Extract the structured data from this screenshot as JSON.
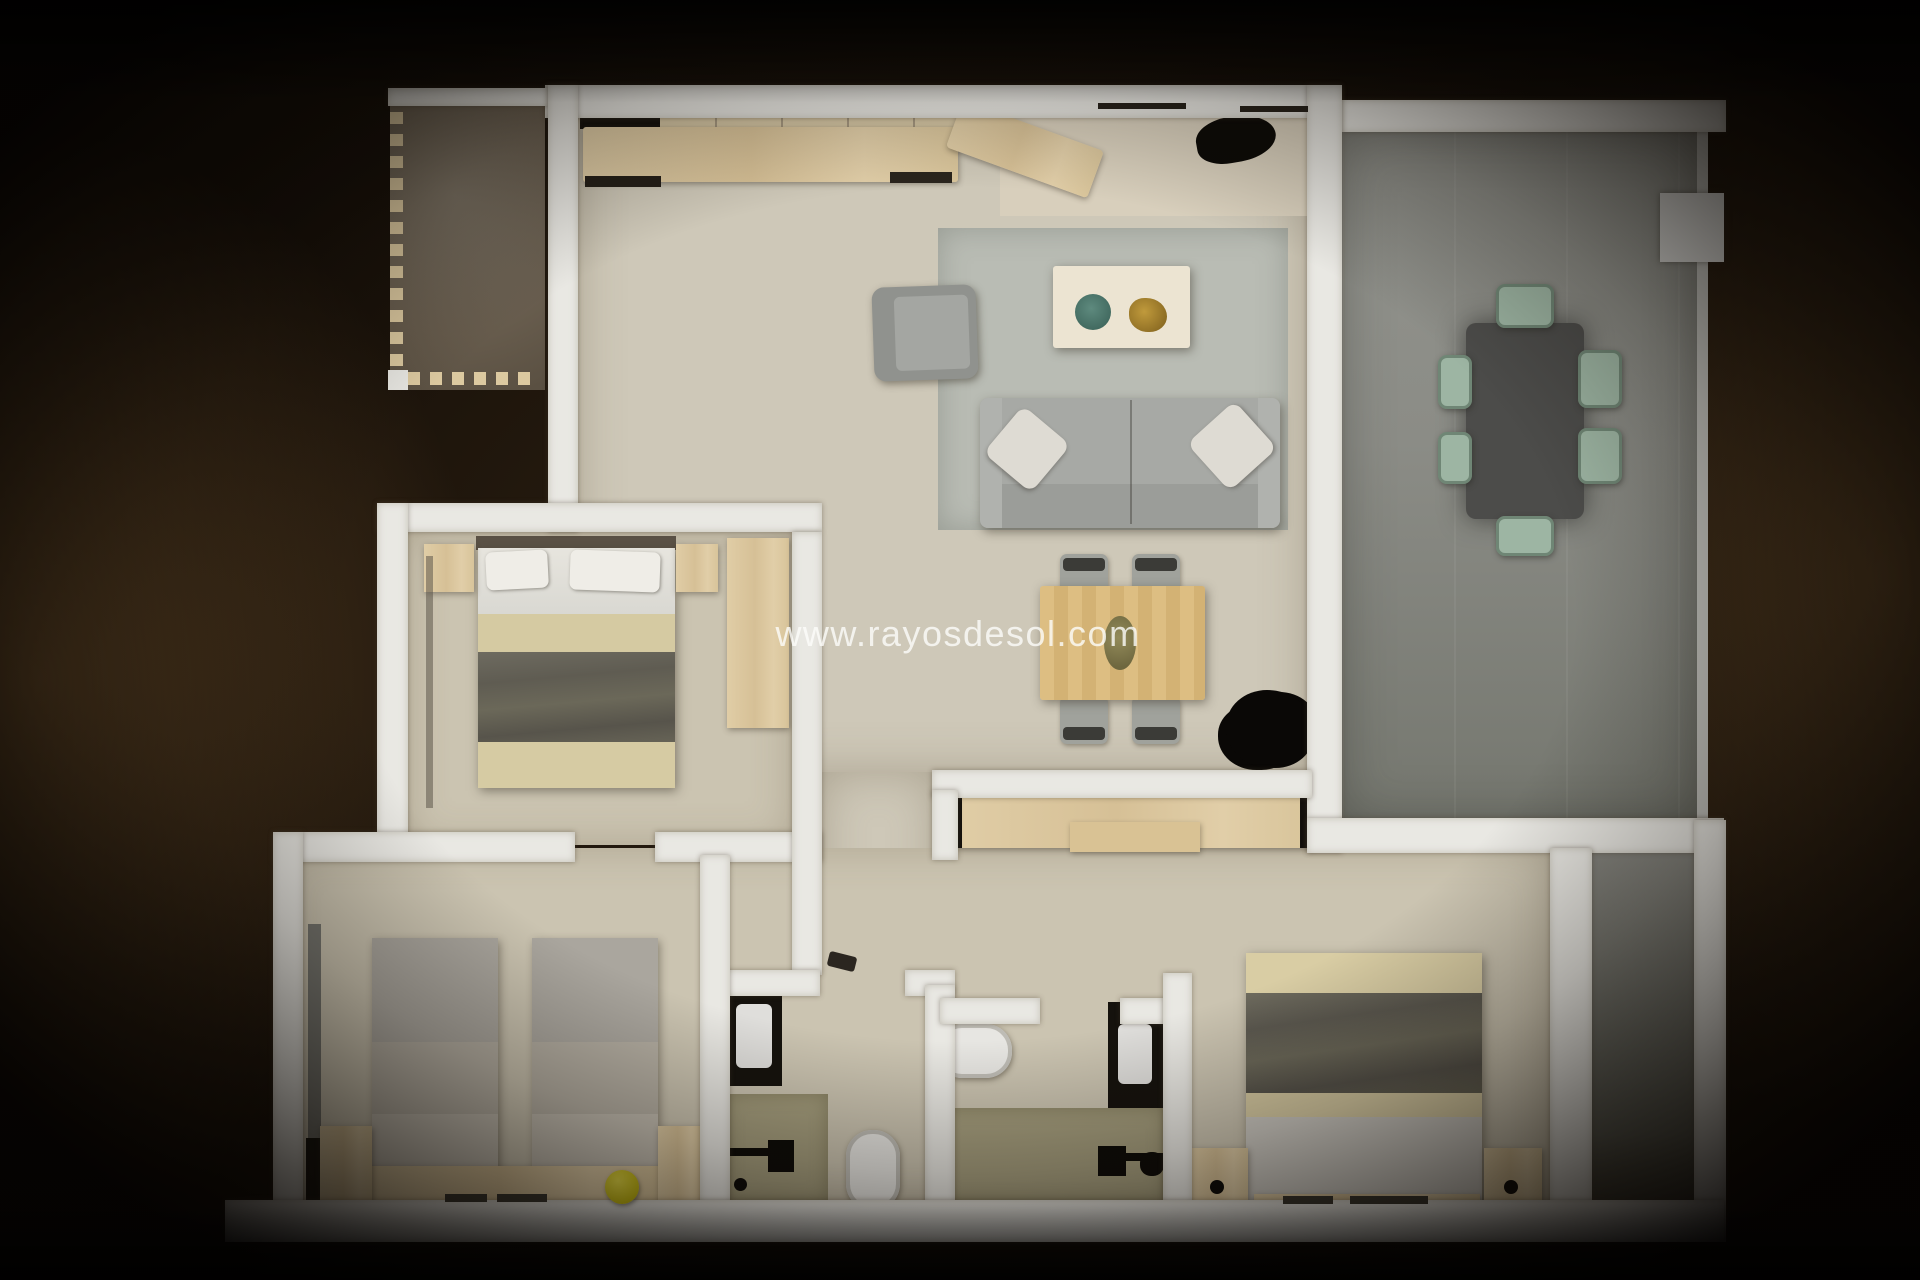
{
  "watermark": {
    "text": "www.rayosdesol.com"
  },
  "scene": {
    "type": "3d-rendered-floor-plan-top-view",
    "description": "Top-down 3D render of an apartment floor plan on a dark brown vignetted background"
  },
  "rooms": [
    {
      "name": "kitchen",
      "furniture": [
        "counter-run",
        "upper-cabinets",
        "black-appliance",
        "corner-counter",
        "sink-unit"
      ]
    },
    {
      "name": "living-room",
      "furniture": [
        "area-rug",
        "sofa-with-pillows",
        "armchair",
        "coffee-table",
        "teal-plate",
        "gold-decor"
      ]
    },
    {
      "name": "dining-area",
      "furniture": [
        "wood-dining-table",
        "centerpiece",
        "four-gray-chairs",
        "black-plant"
      ]
    },
    {
      "name": "terrace-right",
      "furniture": [
        "dark-outdoor-table",
        "six-sage-chairs",
        "wall-unit-box"
      ]
    },
    {
      "name": "balcony-top-left",
      "furniture": [
        "marble-floor",
        "dashed-balustrade"
      ]
    },
    {
      "name": "bedroom-1",
      "furniture": [
        "double-bed-dark-blanket",
        "two-nightstands",
        "wardrobe"
      ]
    },
    {
      "name": "bedroom-2",
      "furniture": [
        "twin-bed-left",
        "twin-bed-right",
        "shared-headboard",
        "two-nightstands",
        "yellow-ball",
        "radiator-strip"
      ]
    },
    {
      "name": "bedroom-3",
      "furniture": [
        "double-bed-dark-blanket",
        "two-nightstands-with-lamps",
        "long-dresser"
      ]
    },
    {
      "name": "bathroom-1",
      "furniture": [
        "black-vanity-with-basin",
        "toilet",
        "olive-shower-floor",
        "shower-fixtures"
      ]
    },
    {
      "name": "bathroom-2",
      "furniture": [
        "black-vanity-with-basin",
        "toilet",
        "olive-shower-floor",
        "shower-fixtures"
      ]
    },
    {
      "name": "corridor",
      "furniture": [
        "door-hinge-mark"
      ]
    }
  ],
  "palette": {
    "background_dark": "#130d07",
    "background_glow": "#85613b",
    "wall": "#e9e8e3",
    "floor_beige": "#cec8b8",
    "kitchen_peninsula": "#d8cfbc",
    "terrace_gray": "#8f908a",
    "balcony_marble": "#6f6759",
    "shower_olive": "#a49d7d",
    "rug_gray": "#b9bcb4",
    "sofa_gray": "#a5a7a3",
    "wood_light": "#dcc9a2",
    "dining_wood": "#dcbc80",
    "blanket_dark": "#68655a",
    "bed_sand": "#d8cda6",
    "chair_sage": "#9db5a3",
    "outdoor_table_charcoal": "#4c4c4a",
    "fixture_black": "#12100c",
    "ball_yellow": "#d7ca1d",
    "plate_teal": "#527d72",
    "decor_gold": "#a9842e"
  }
}
